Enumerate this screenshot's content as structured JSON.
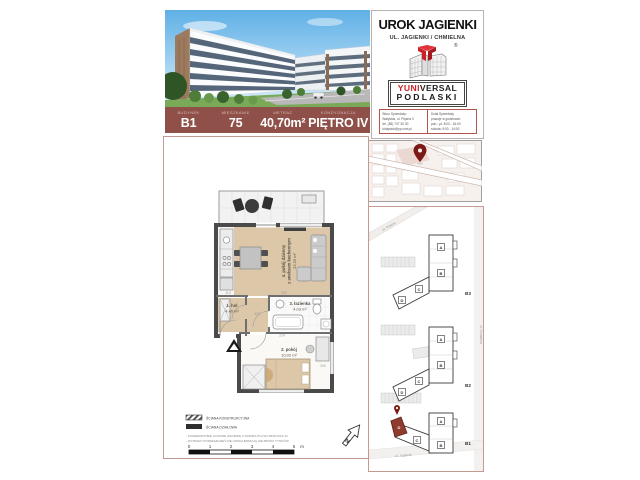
{
  "header": {
    "title": "UROK JAGIENKI",
    "subtitle": "UL. JAGIENKI / CHMIELNA",
    "brand": {
      "registered": "®",
      "name_accent": "YUNI",
      "name_rest": "VERSAL",
      "name_line2": "PODLASKI"
    },
    "contact": {
      "left": [
        "Biuro Sprzedaży:",
        "Białystok, ul. Piękna 3",
        "tel. (85) 747 30 30",
        "bialystok@yp.com.pl"
      ],
      "right": [
        "Dział Sprzedaży",
        "pracuje w godzinach:",
        "pon.- pt. 8:00 - 16:00",
        "sobota: 9:00 - 14:00"
      ]
    }
  },
  "banner": {
    "items": [
      {
        "label": "BUDYNEK",
        "value": "B1"
      },
      {
        "label": "MIESZKANIE",
        "value": "75"
      },
      {
        "label": "METRAŻ",
        "value": "40,70m²"
      },
      {
        "label": "KONDYGNACJA",
        "value": "PIĘTRO IV"
      }
    ]
  },
  "floorplan": {
    "living_label_lines": [
      "4. pokój dzienny",
      "z aneksem kuchennym",
      "22,25 m²"
    ],
    "rooms": [
      {
        "label": "1. hol",
        "area": "4,40 m²"
      },
      {
        "label": "2. pokój",
        "area": "10,02 m²"
      },
      {
        "label": "3. łazienka",
        "area": "4,03 m²"
      }
    ],
    "dimensions": [
      "110",
      "352",
      "323",
      "214",
      "340"
    ]
  },
  "legend": {
    "wall_structural": "ŚCIANA KONSTRUKCYJNA",
    "wall_partition": "ŚCIANA DZIAŁOWA",
    "notes": [
      "- POWIERZCHNIE LICZONE ZGODNIE Z NORMĄ PN-ISO 9836:2015-12",
      "- WYMIARY POMIESZCZEŃ NIE UWZGLĘDNIAJĄ GRUBOŚCI TYNKÓW"
    ],
    "scale": {
      "ticks": [
        "0",
        "1",
        "2",
        "3",
        "4",
        "5"
      ],
      "unit": "m"
    },
    "north": "N"
  },
  "siteplan": {
    "streets": {
      "piekna": "ul. Piękna",
      "chmielna": "ul. Chmielna",
      "jagienki": "ul. Jagienki"
    },
    "buildings": {
      "b3": "B3",
      "b2": "B2",
      "b1": "B1"
    },
    "sections": [
      "A",
      "B",
      "C",
      "D"
    ]
  },
  "colors": {
    "banner": "#8e5048",
    "brand_red": "#cc2127",
    "highlight": "#8f3b2e",
    "panel_border": "#c59a92",
    "pin": "#7c1a15"
  }
}
